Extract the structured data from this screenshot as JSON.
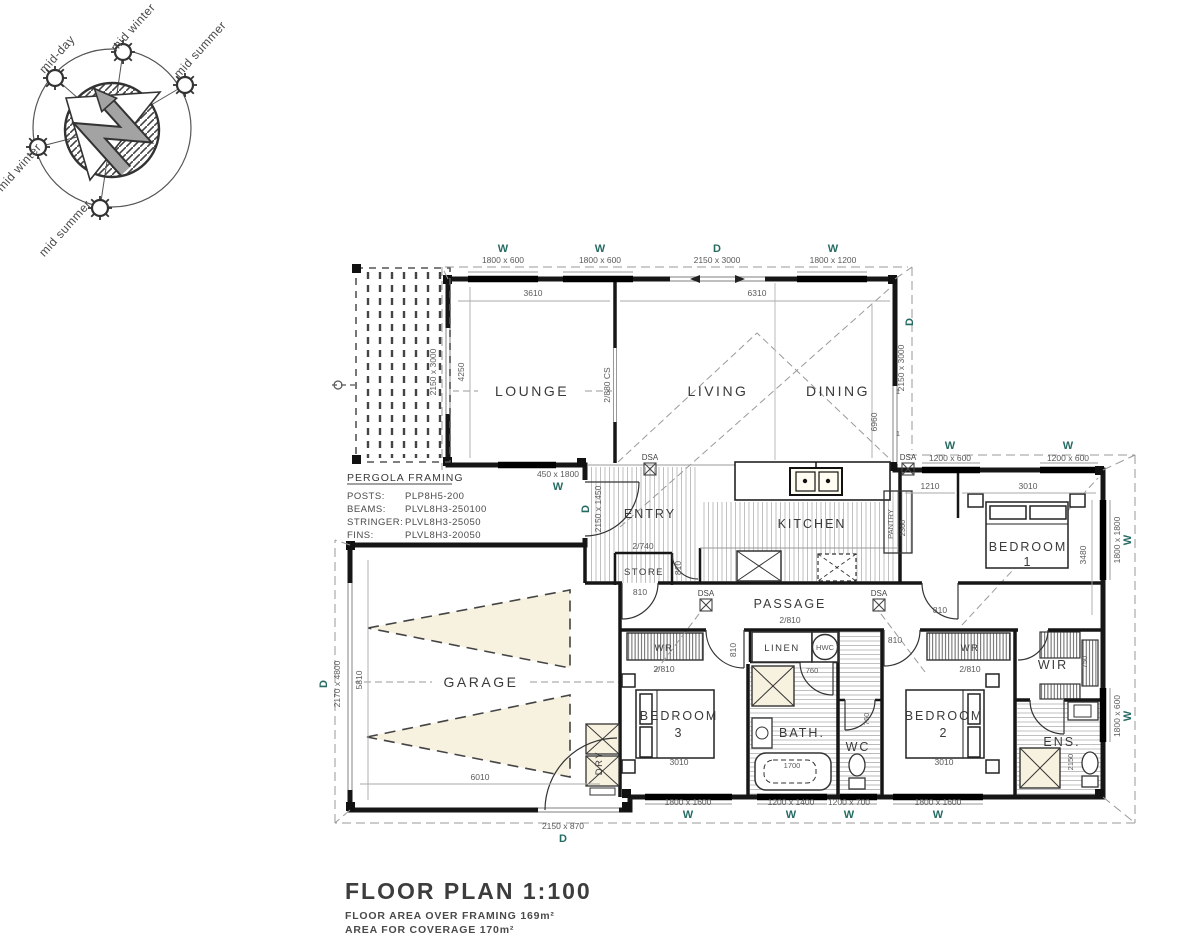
{
  "sun_diagram": {
    "labels": [
      "mid-day",
      "mid winter",
      "mid summer",
      "mid winter",
      "mid summer"
    ]
  },
  "pergola_note": {
    "title": "PERGOLA FRAMING",
    "rows": [
      [
        "POSTS:",
        "PLP8H5-200"
      ],
      [
        "BEAMS:",
        "PLVL8H3-250100"
      ],
      [
        "STRINGER:",
        "PLVL8H3-25050"
      ],
      [
        "FINS:",
        "PLVL8H3-20050"
      ]
    ]
  },
  "rooms": {
    "lounge": "LOUNGE",
    "living": "LIVING",
    "dining": "DINING",
    "entry": "ENTRY",
    "kitchen": "KITCHEN",
    "store": "STORE",
    "pantry": "PANTRY",
    "passage": "PASSAGE",
    "garage": "GARAGE",
    "dry": "DRY",
    "bed1a": "BEDROOM",
    "bed1b": "1",
    "bed2a": "BEDROOM",
    "bed2b": "2",
    "bed3a": "BEDROOM",
    "bed3b": "3",
    "bath": "BATH.",
    "wc": "WC",
    "linen": "LINEN",
    "hwc": "HWC",
    "wir": "WIR",
    "ens": "ENS.",
    "wr": "WR"
  },
  "openings": {
    "w": "W",
    "d": "D",
    "dsa": "DSA",
    "top": [
      "1800 x 600",
      "1800 x 600",
      "2150 x 3000",
      "1800 x 1200"
    ],
    "wing_top": [
      "1200 x 600",
      "1200 x 600"
    ],
    "bottom": [
      "1800 x 1600",
      "1200 x 1400",
      "1200 x 700",
      "1800 x 1600"
    ],
    "lounge_side": "2150 x 3000",
    "dining_side": "2150 x 3000",
    "pergola_window": "450 x 1800",
    "entry_door": "2150 x 1450",
    "garage_door": "2170 x 4800",
    "garage_rear": "2150 x 870",
    "bed1_window": "1800 x 1800",
    "ens_window": "1800 x 600",
    "cavity_slider": "2/880 CS",
    "store_door": "2/740",
    "passage_cs": "2/810",
    "wr_door": "2/810",
    "door810": "810",
    "door760": "760",
    "panel": "1"
  },
  "dims": {
    "lounge_w": "3610",
    "living_w": "6310",
    "lounge_d": "4250",
    "dining_d": "6960",
    "garage_d": "5810",
    "garage_w": "6010",
    "bed1_w": "3010",
    "bed1_d": "3480",
    "nook": "1210",
    "pantry_d": "2360",
    "bed2_w": "3010",
    "bed3_w": "3010",
    "tub": "1700",
    "wir": "750",
    "ens": "2150"
  },
  "title_block": {
    "title": "FLOOR PLAN  1:100",
    "note1": "FLOOR AREA OVER FRAMING 169m²",
    "note2": "AREA FOR COVERAGE 170m²"
  }
}
